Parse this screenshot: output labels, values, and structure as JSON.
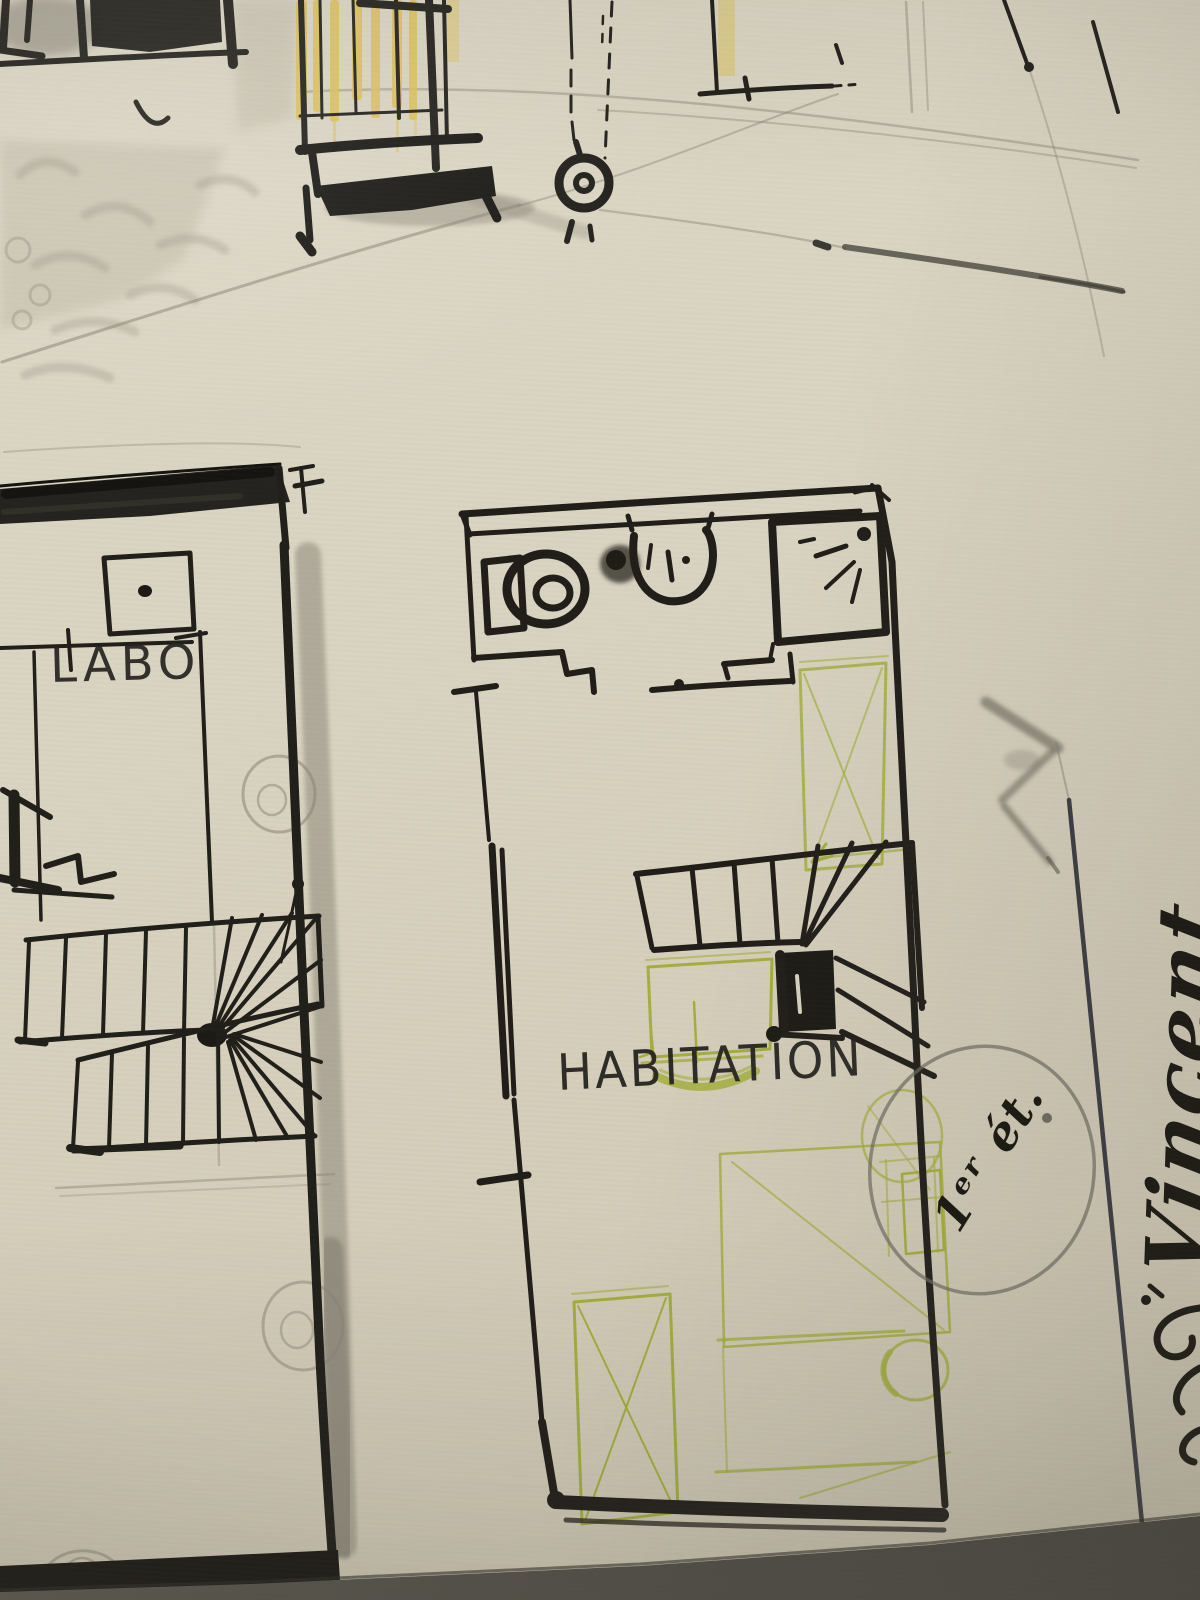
{
  "sketch": {
    "rooms": [
      {
        "id": "labo",
        "label": "LABO"
      },
      {
        "id": "habitation",
        "label": "HABITATION"
      }
    ],
    "annotations": {
      "floor_note": "1ᵉʳ ét.",
      "signature": "Vincent"
    },
    "symbols": [
      "shuttered-window-icon",
      "balcony-icon",
      "hanging-ring-icon",
      "toilet-icon",
      "washbasin-icon",
      "shower-icon",
      "winder-staircase-icon",
      "bed-sketch",
      "wardrobe-sketch",
      "door-swing-pencil-circle"
    ],
    "colors": {
      "paper": "#d8d2c0",
      "ink": "#211f1a",
      "gray_wash": "#8d8779",
      "yellow_watercolor": "#dfc35a",
      "green_pencil": "#a4af3e",
      "graphite": "#8a8478",
      "ballpoint_line": "#3a3a41",
      "table_surface": "#4f4e46"
    }
  }
}
